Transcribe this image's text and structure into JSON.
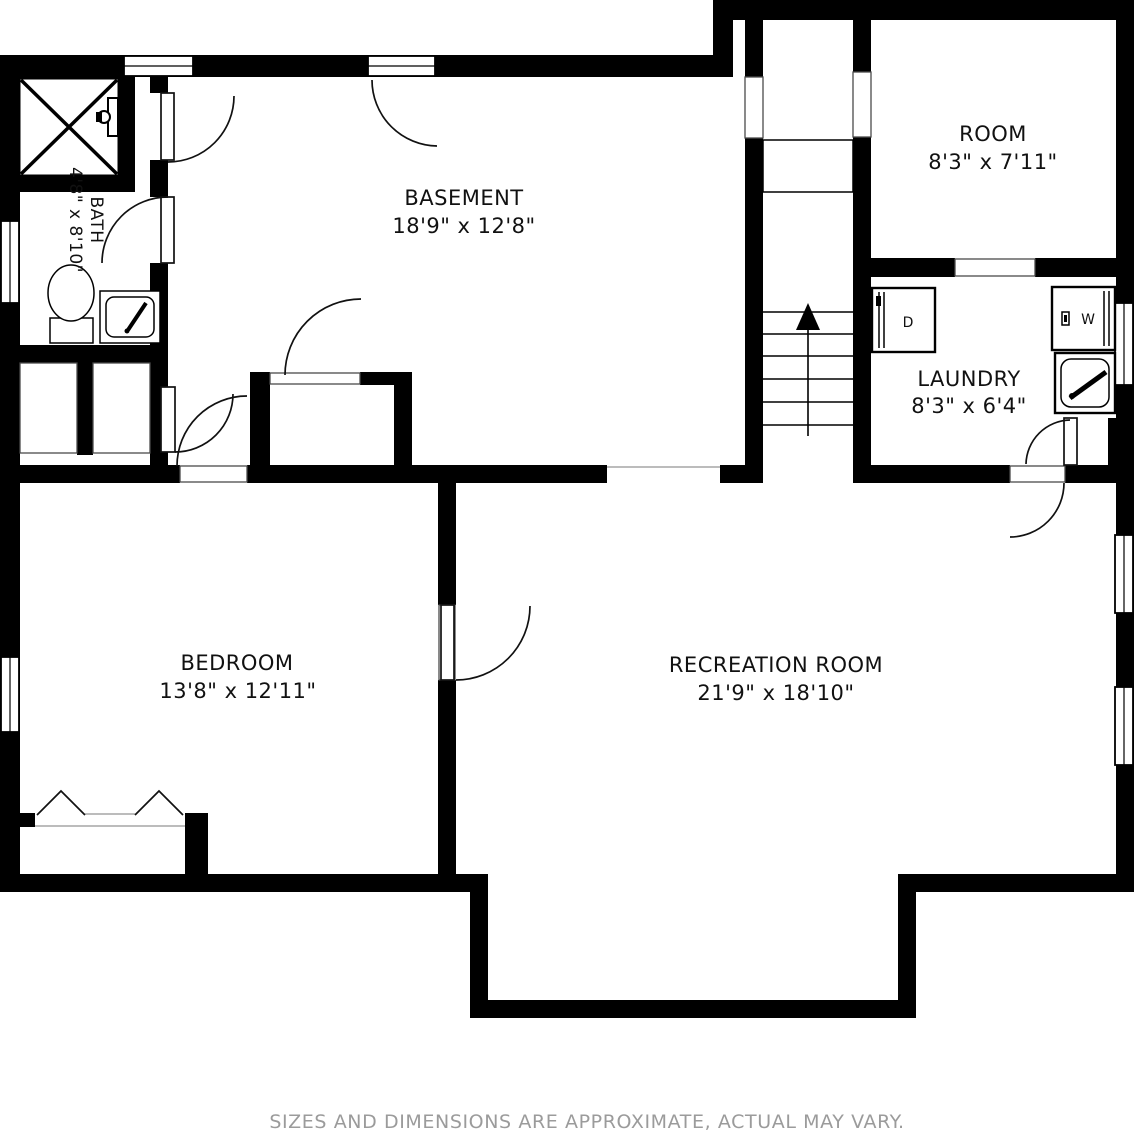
{
  "plan": {
    "title": "basement-floor-plan",
    "rooms": [
      {
        "id": "basement",
        "name": "BASEMENT",
        "dims": "18'9\" x 12'8\""
      },
      {
        "id": "room",
        "name": "ROOM",
        "dims": "8'3\" x 7'11\""
      },
      {
        "id": "laundry",
        "name": "LAUNDRY",
        "dims": "8'3\" x 6'4\""
      },
      {
        "id": "bath",
        "name": "BATH",
        "dims": "4'8\" x 8'10\""
      },
      {
        "id": "bedroom",
        "name": "BEDROOM",
        "dims": "13'8\" x 12'11\""
      },
      {
        "id": "recreation",
        "name": "RECREATION ROOM",
        "dims": "21'9\" x 18'10\""
      }
    ],
    "appliances": {
      "dryer_label": "D",
      "washer_label": "W"
    },
    "colors": {
      "wall": "#000000",
      "background": "#ffffff",
      "disclaimer_text": "#9b9b9b"
    }
  },
  "footer": {
    "disclaimer": "SIZES AND DIMENSIONS ARE APPROXIMATE, ACTUAL MAY VARY."
  }
}
